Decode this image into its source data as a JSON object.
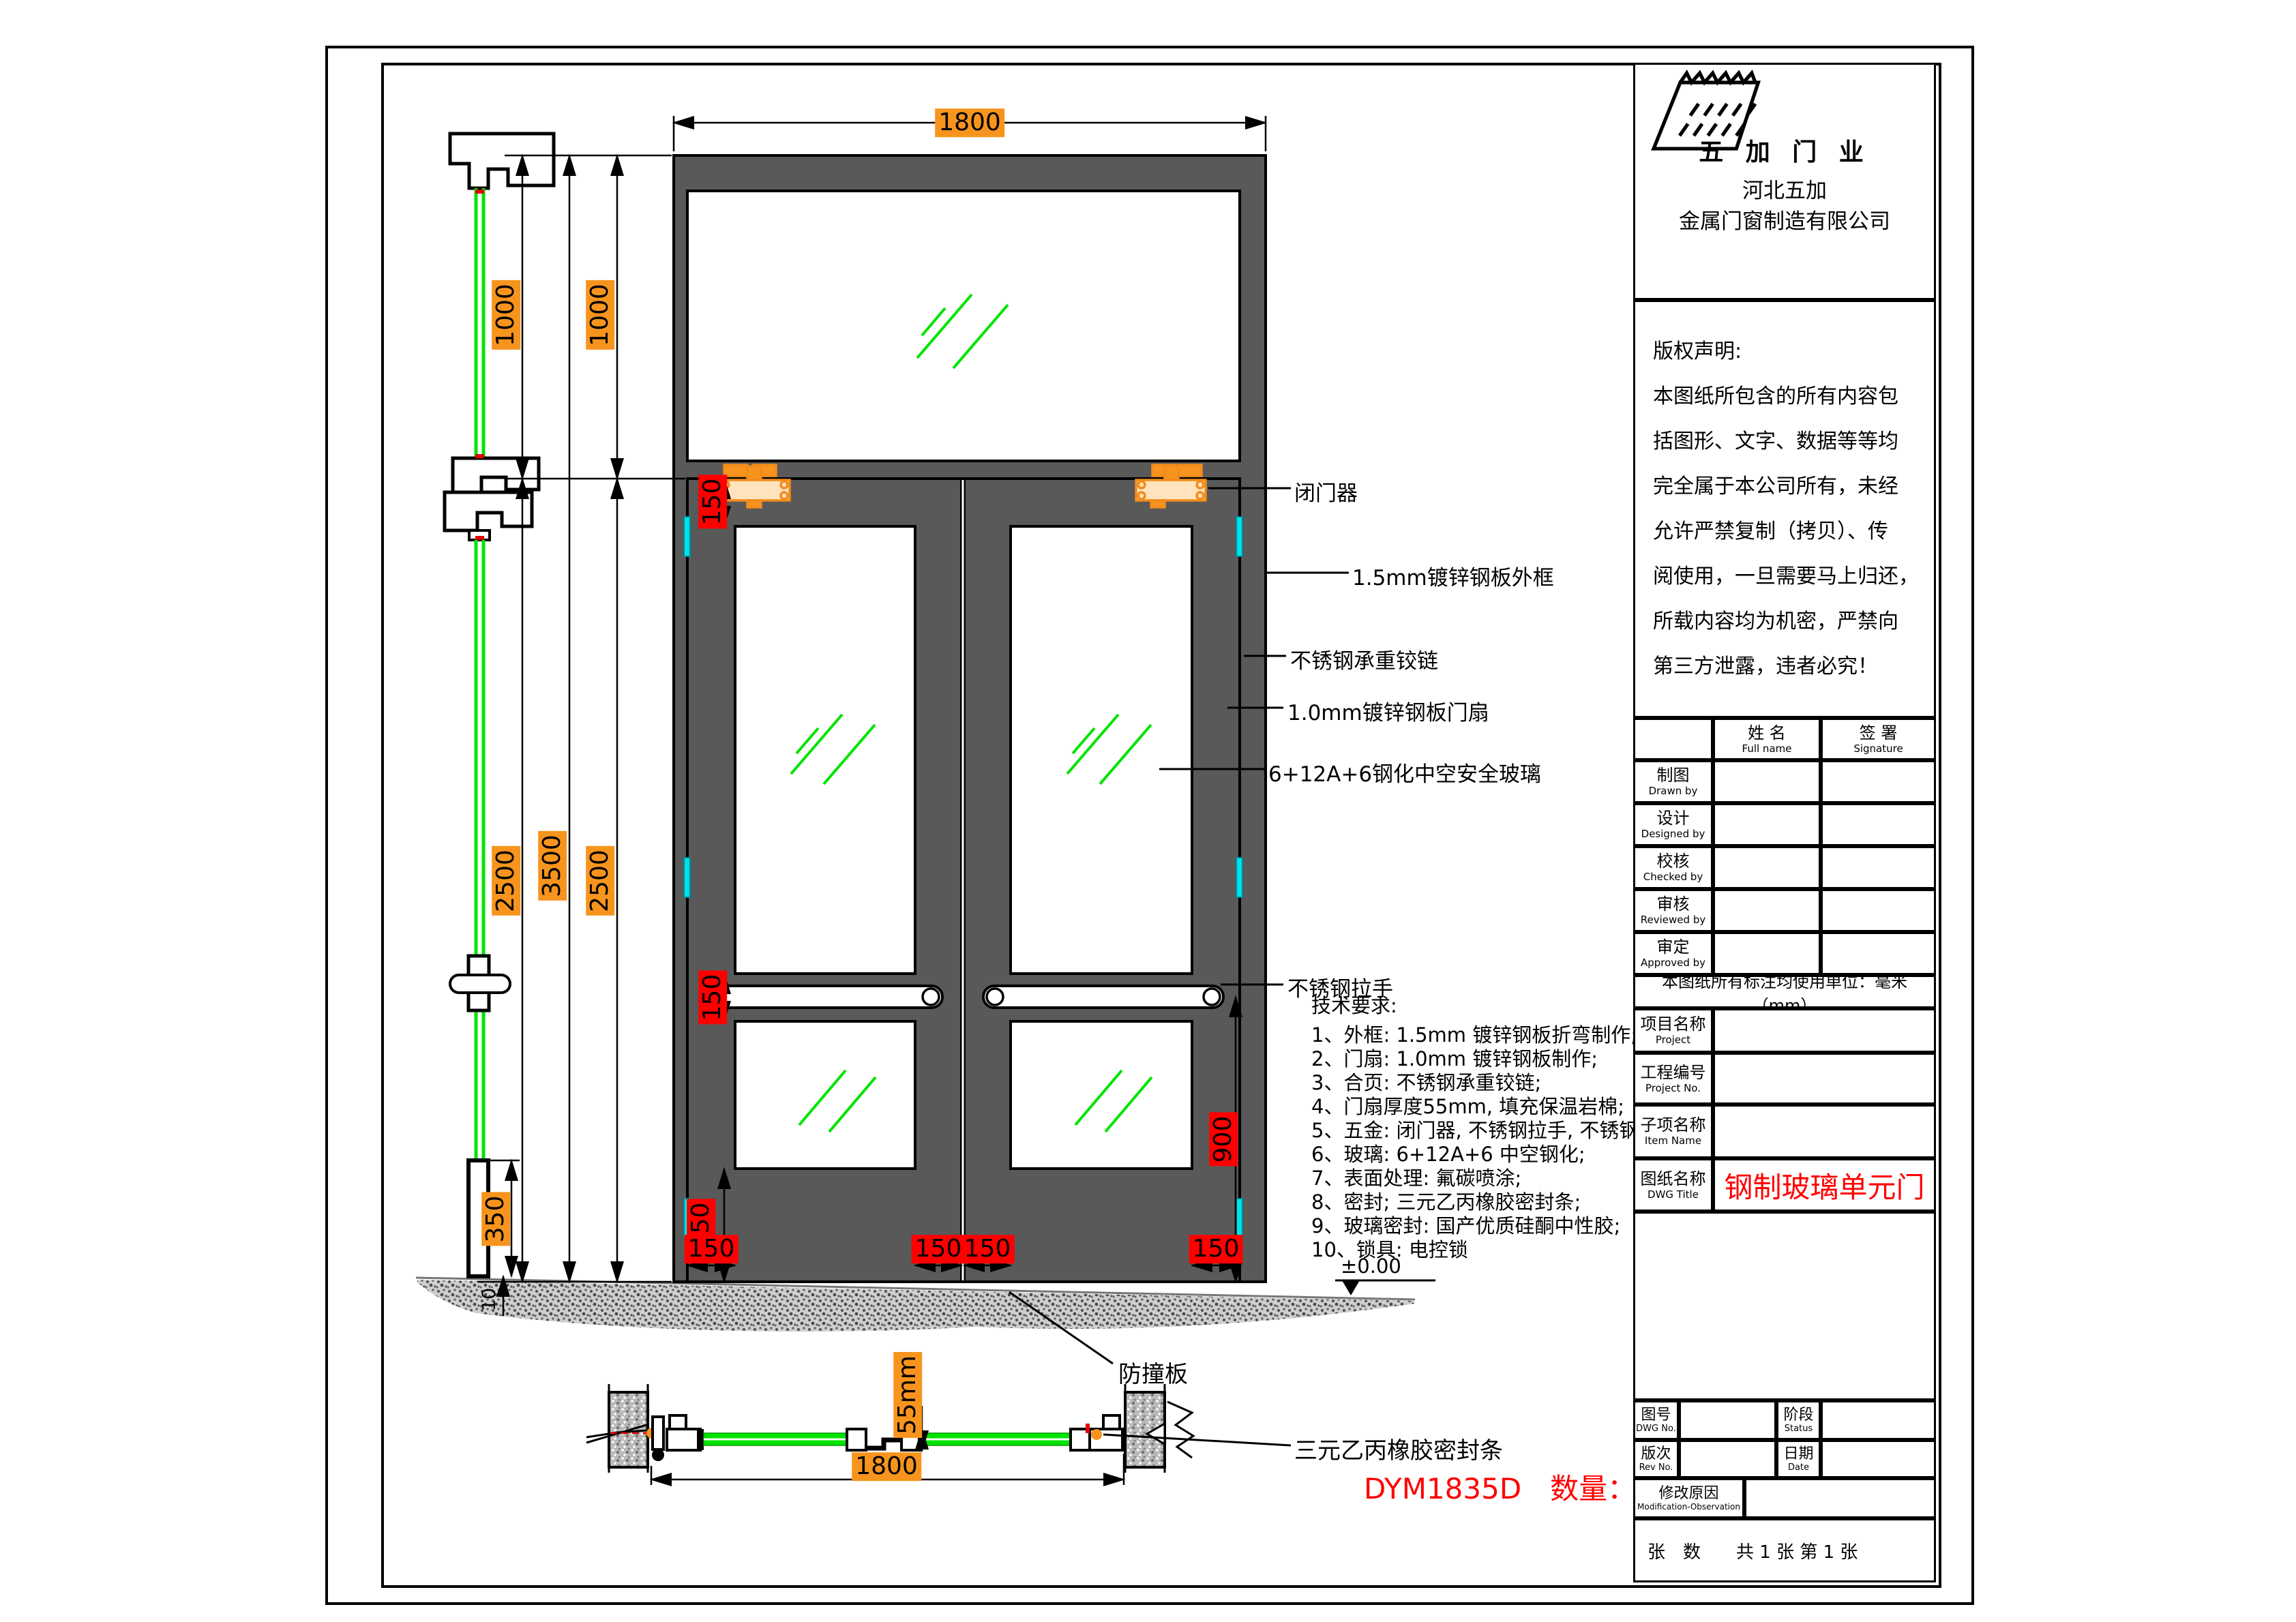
{
  "company": {
    "brand": "五 加 门 业",
    "name_line1": "河北五加",
    "name_line2": "金属门窗制造有限公司"
  },
  "copyright": {
    "lines": [
      "版权声明:",
      "本图纸所包含的所有内容包",
      "括图形、文字、数据等等均",
      "完全属于本公司所有，未经",
      "允许严禁复制（拷贝）、传",
      "阅使用，一旦需要马上归还，",
      "所载内容均为机密，严禁向",
      "第三方泄露，违者必究！"
    ]
  },
  "sign_table": {
    "name_cn": "姓  名",
    "name_en": "Full name",
    "sig_cn": "签  署",
    "sig_en": "Signature",
    "rows": [
      {
        "cn": "制图",
        "en": "Drawn by",
        "name": "",
        "sig": ""
      },
      {
        "cn": "设计",
        "en": "Designed by",
        "name": "",
        "sig": ""
      },
      {
        "cn": "校核",
        "en": "Checked by",
        "name": "",
        "sig": ""
      },
      {
        "cn": "审核",
        "en": "Reviewed by",
        "name": "",
        "sig": ""
      },
      {
        "cn": "审定",
        "en": "Approved by",
        "name": "",
        "sig": ""
      }
    ]
  },
  "units_note": "本图纸所有标注均使用单位：毫米（mm）",
  "fields": [
    {
      "cn": "项目名称",
      "en": "Project",
      "value": ""
    },
    {
      "cn": "工程编号",
      "en": "Project No.",
      "value": ""
    },
    {
      "cn": "子项名称",
      "en": "Item Name",
      "value": ""
    },
    {
      "cn": "图纸名称",
      "en": "DWG Title",
      "value": "钢制玻璃单元门"
    }
  ],
  "bottom_rows": {
    "dwg_no_cn": "图号",
    "dwg_no_en": "DWG No.",
    "dwg_no_value": "",
    "status_cn": "阶段",
    "status_en": "Status",
    "status_value": "",
    "rev_cn": "版次",
    "rev_en": "Rev No.",
    "rev_value": "",
    "date_cn": "日期",
    "date_en": "Date",
    "date_value": "",
    "mod_cn": "修改原因",
    "mod_en": "Modification-Observation",
    "mod_value": "",
    "sheets": "张　数　　共 1 张  第 1 张"
  },
  "dims": {
    "opening_width": "1800",
    "transom_height": "1000",
    "door_height": "2500",
    "total_height": "3500",
    "rail": "150",
    "kick_rail": "350",
    "stile": "150",
    "handle_height": "900",
    "leaf_thickness": "55mm",
    "floor_gap": "10",
    "plan_width": "1800"
  },
  "annotations": {
    "door_closer": "闭门器",
    "outer_frame": "1.5mm镀锌钢板外框",
    "hinge": "不锈钢承重铰链",
    "door_leaf": "1.0mm镀锌钢板门扇",
    "glazing": "6+12A+6钢化中空安全玻璃",
    "pull_handle": "不锈钢拉手",
    "kick_plate": "防撞板",
    "seal_strip": "三元乙丙橡胶密封条",
    "floor_level": "±0.00"
  },
  "tech_requirements": {
    "title": "技术要求:",
    "items": [
      "1、外框: 1.5mm 镀锌钢板折弯制作;",
      "2、门扇: 1.0mm 镀锌钢板制作;",
      "3、合页: 不锈钢承重铰链;",
      "4、门扇厚度55mm, 填充保温岩棉;",
      "5、五金: 闭门器, 不锈钢拉手, 不锈钢插销;",
      "6、玻璃: 6+12A+6 中空钢化;",
      "7、表面处理: 氟碳喷涂;",
      "8、密封; 三元乙丙橡胶密封条;",
      "9、玻璃密封: 国产优质硅酮中性胶;",
      "10、锁具: 电控锁"
    ]
  },
  "product": {
    "model_and_qty": "DYM1835D　数量：6樘"
  },
  "colors": {
    "dim_orange": "#F7941D",
    "dim_red": "#FF0000",
    "glass_green": "#00E400",
    "hinge_cyan": "#00E0E8",
    "closer_orange": "#F28C1B",
    "door_gray": "#595959",
    "dwg_title_red": "#FF0000"
  }
}
